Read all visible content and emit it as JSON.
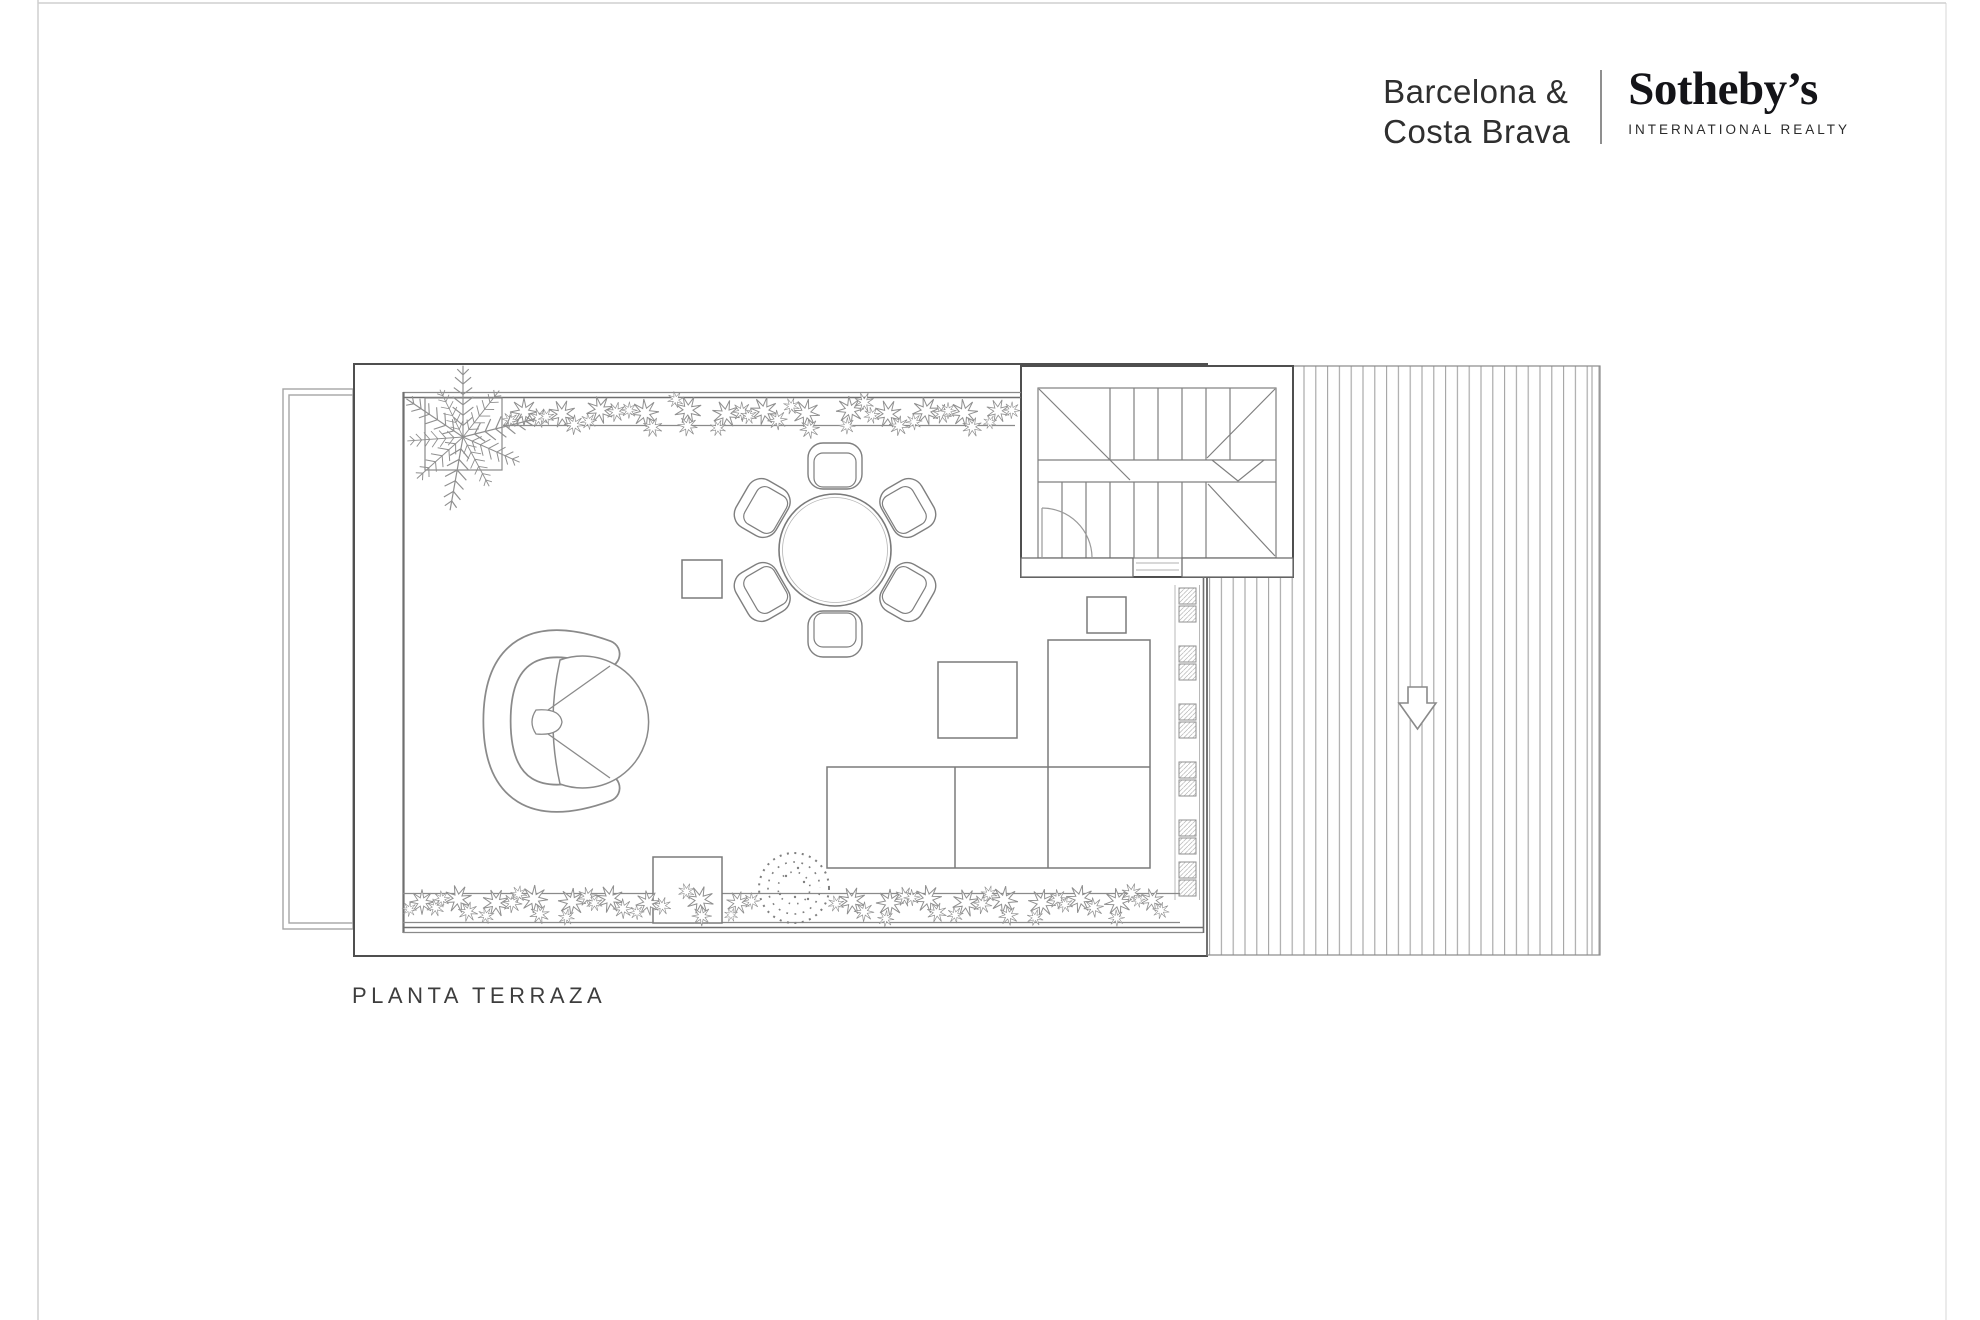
{
  "brand": {
    "region_line1": "Barcelona &",
    "region_line2": "Costa Brava",
    "name": "Sotheby’s",
    "subtitle": "INTERNATIONAL REALTY"
  },
  "plan": {
    "title": "PLANTA TERRAZA",
    "elements": [
      "terrace-outline",
      "side-annex",
      "staircase",
      "wood-deck",
      "down-arrow",
      "palm-tree",
      "top-planter",
      "bottom-planter",
      "planter-modules",
      "dining-table",
      "dining-chairs-x6",
      "lounge-chair",
      "sectional-sofa",
      "coffee-table",
      "side-table-small",
      "side-table-near-stairs",
      "planter-box-square",
      "round-bush"
    ]
  },
  "colors": {
    "background": "#ffffff",
    "page_frame": "#cfcfcf",
    "plan_dark_line": "#4f4f4f",
    "plan_line": "#7a7a7a",
    "plan_light_line": "#a6a6a6",
    "brand_text": "#2f2f2f",
    "brand_serif": "#141418",
    "label_text": "#3d3d3d"
  }
}
